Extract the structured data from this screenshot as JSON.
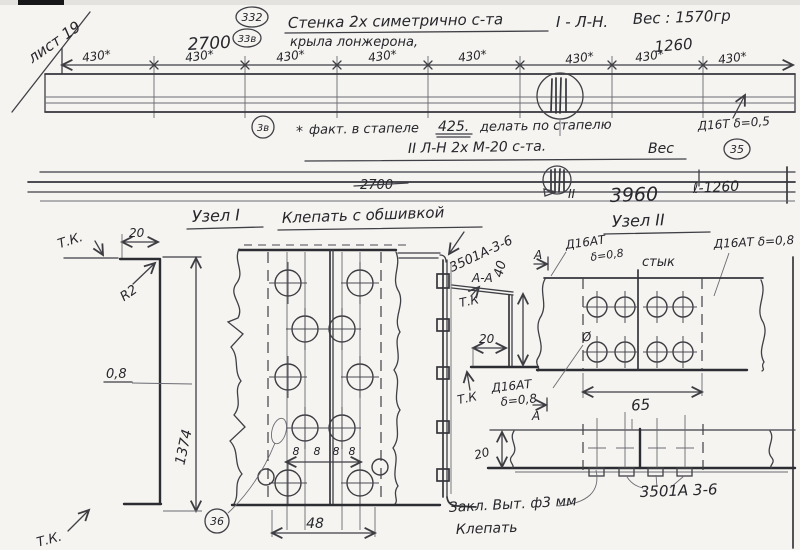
{
  "page": {
    "sheet_note": "лист 19"
  },
  "title": {
    "balloon_a": "332",
    "balloon_b": "33в",
    "line1": "Стенка 2х симетрично с-та",
    "code": "I - Л-Н.",
    "line2": "крыла лонжерона,",
    "weight": "Вес : 1570гр"
  },
  "top_view": {
    "dim_left": "2700",
    "dim_right": "1260",
    "bay_dims": [
      "430*",
      "430*",
      "430*",
      "430*",
      "430*",
      "430*",
      "430*",
      "430*"
    ],
    "balloon_note": "3в",
    "note_star": "*",
    "note_a": "факт. в стапеле",
    "note_value": "425.",
    "note_b": "делать по стапелю",
    "material": "Д16Т δ=0,5",
    "balloon_mat": "35"
  },
  "second_view": {
    "header": "II  Л-Н  2х  М-20  с-та.",
    "weight_label": "Вес",
    "dim_2700": "2700",
    "detail_mark": "II",
    "dim_3960": "3960",
    "dim_l": "ℓ-1260"
  },
  "node1": {
    "header": "Узел I",
    "note": "Клепать с обшивкой",
    "tk_top": "Т.К.",
    "tk_bottom": "Т.К.",
    "dim_top": "20",
    "radius": "R2",
    "thickness": "0,8",
    "height": "1374",
    "balloon": "36",
    "pitch": [
      "8",
      "8",
      "8",
      "8"
    ],
    "dim_row": "48"
  },
  "section_aa": {
    "part": "3501А-3-6",
    "label": "А-А",
    "tk_upper": "Т.К",
    "tk_lower": "Т.К",
    "dim_h": "40",
    "dim_w": "20",
    "mat1": "Д16АТ",
    "mat2": "δ=0,8",
    "cut_top": "А",
    "cut_bottom": "А"
  },
  "node2": {
    "header": "Узел II",
    "mat_left1": "Д16АТ",
    "mat_left2": "δ=0,8",
    "joint": "стык",
    "mat_right": "Д16АТ δ=0,8",
    "dia": "Ø",
    "dim_width": "65"
  },
  "strip": {
    "dim_h": "20",
    "note1": "Закл. Выт. ф3 мм",
    "note2": "Клепать",
    "part": "3501А 3-6"
  }
}
